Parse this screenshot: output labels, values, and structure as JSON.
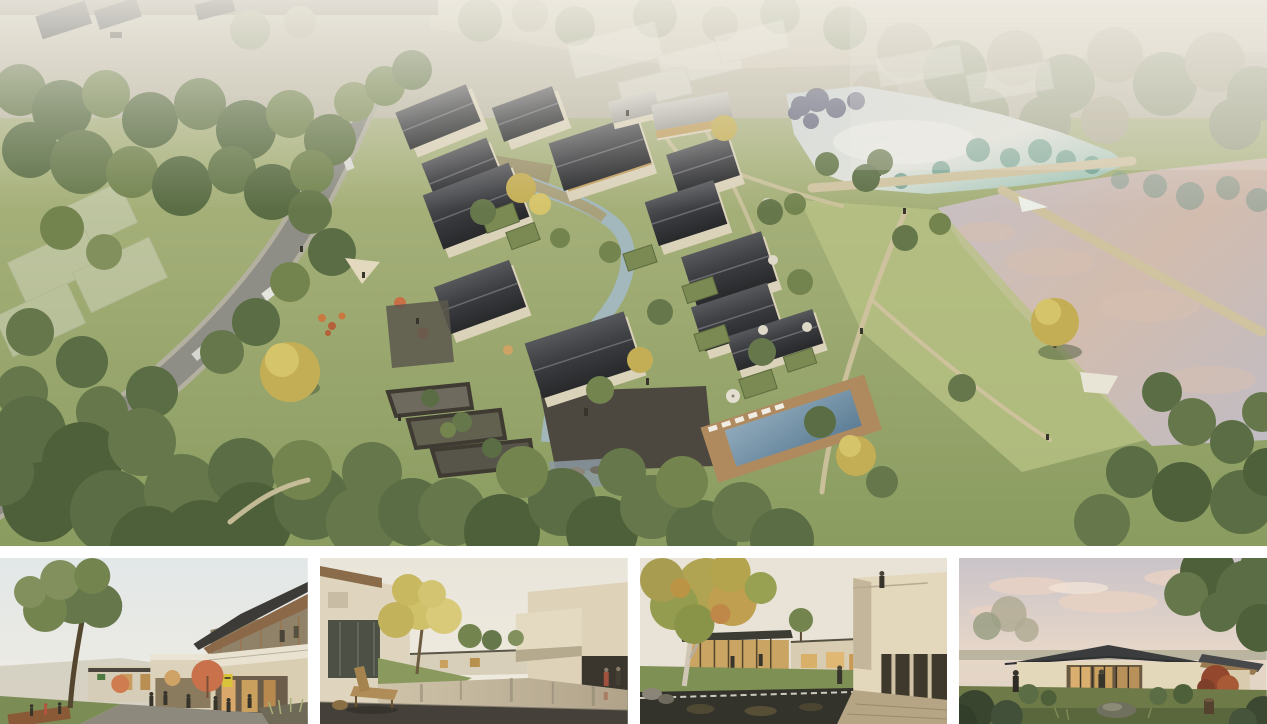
{
  "page": {
    "background_color": "#ffffff",
    "description": "Collage of five architectural renderings: a large aerial masterplan view above a row of four eye-level renderings separated by white gutters"
  },
  "collage": {
    "main_render": {
      "name": "aerial-masterplan-render",
      "alt": "Aerial rendering of a courtyard village resort: clusters of dark pitched-roof houses with cream walls along a winding stream, a stone plaza and swimming-pool terrace, a curving grey road through woodland on the left, translucent future-phase buildings near the top, and two ponds with grass dykes and footpaths on the right",
      "palette": {
        "grass": "#a3b075",
        "sunlit_grass": "#bcc48c",
        "forest_green": "#566a40",
        "roof_dark": "#35363a",
        "wall_cream": "#dbd2ba",
        "road_grey": "#8e8e86",
        "stream_blue": "#a9bfc8",
        "pond_teal": "#6f9c8c",
        "lake_pink_grey": "#c7bab6",
        "pool_blue": "#7494aa",
        "path_tan": "#cfc3a0",
        "haze_white": "#f2efe6"
      }
    },
    "thumbnails": [
      {
        "name": "street-plaza-render",
        "alt": "Eye-level view of a two-storey retail lane with a large timber-soffit roof, cafe terraces with orange umbrellas, visitors on a paved street and a large tree over a lawn",
        "palette": {
          "sky": "#e7eae8",
          "wall": "#d9cdb2",
          "roof": "#3c3b37",
          "wood": "#8a6848",
          "umbrella": "#c9714a",
          "lawn": "#7c8c55"
        }
      },
      {
        "name": "reflecting-pool-courtyard-render",
        "alt": "Courtyard with a still reflecting pool between cream rendered houses, a golden tree on a grass mound and a wooden bench on a dark stone deck in the foreground",
        "palette": {
          "sky": "#ece7db",
          "wall": "#dfd5bf",
          "water": "#c3b69c",
          "tree_gold": "#cfc06a",
          "deck": "#45413a",
          "bench": "#b08c58"
        }
      },
      {
        "name": "pond-garden-courtyard-render",
        "alt": "Garden courtyard with a dark koi pond and weir in the foreground, a large autumn tree, glazed pavilions glowing warmly and a cantilevered cream balcony with a figure standing on top",
        "palette": {
          "sky": "#e9e3d7",
          "wall": "#e3d7bc",
          "pond": "#34332b",
          "canopy": "#b0a452",
          "glow": "#d8b06a",
          "stone": "#b5a585"
        }
      },
      {
        "name": "dusk-pavilion-render",
        "alt": "Single-storey glass pavilion with a dark standing-seam roof glowing warmly at dusk under a pink-clouded sky, framed by large trees, low shrubs, a rock and a red maple",
        "palette": {
          "sky_top": "#c9c3c8",
          "cloud_pink": "#e9d2c4",
          "roof": "#3a3c3e",
          "wall": "#e4d8ba",
          "glow": "#d9ae6e",
          "lawn": "#6e7a48"
        }
      }
    ]
  }
}
